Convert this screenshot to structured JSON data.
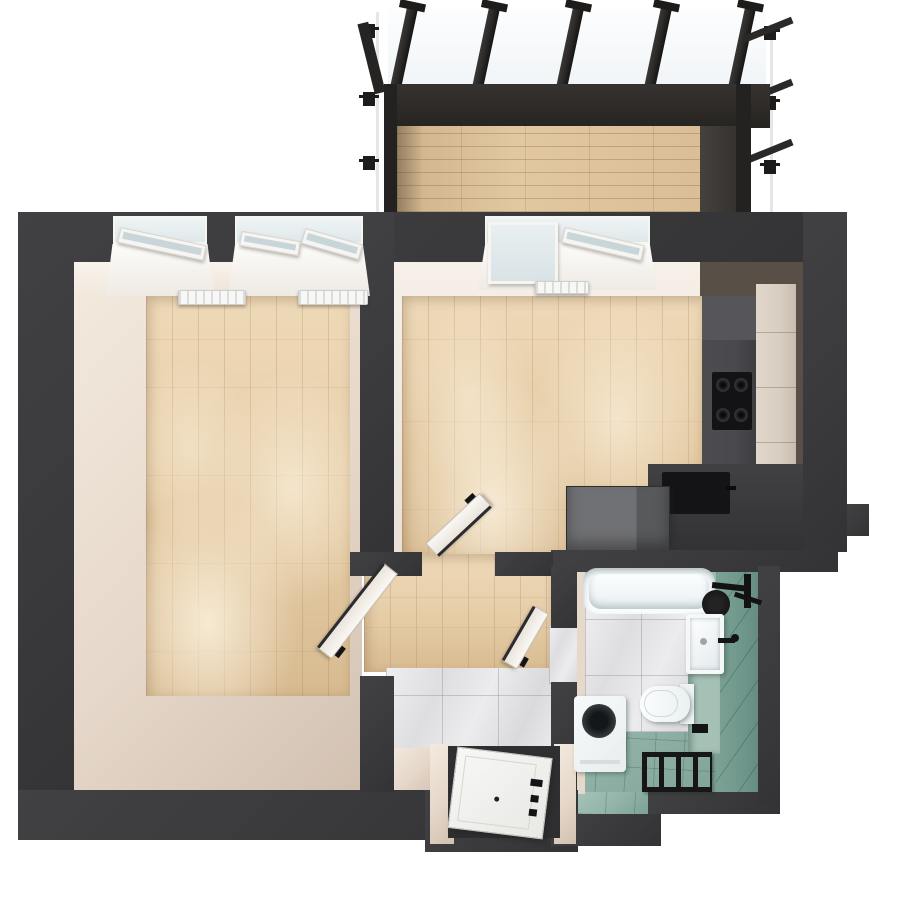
{
  "scene": {
    "type": "3d-floor-plan-top-view",
    "rooms": [
      {
        "name": "balcony",
        "floor": "wood-deck",
        "features": [
          "pergola-rafters",
          "glass-railing",
          "metal-frame"
        ]
      },
      {
        "name": "living-room",
        "floor": "wood-planks",
        "features": [
          "window-1",
          "window-2",
          "radiator-1",
          "radiator-2",
          "open-door-to-hallway"
        ]
      },
      {
        "name": "kitchen",
        "floor": "wood-planks",
        "features": [
          "balcony-door",
          "tilted-window",
          "radiator-3",
          "tall-cabinets",
          "gas-hob",
          "counter-sink",
          "island",
          "open-door-to-hallway"
        ]
      },
      {
        "name": "hallway",
        "floor": "wood-and-marble-tile",
        "features": [
          "entrance-door",
          "door-to-bathroom"
        ]
      },
      {
        "name": "bathroom",
        "floor": "teal-tile-and-marble",
        "features": [
          "bathtub",
          "black-shower",
          "washbasin",
          "wall-hung-toilet",
          "washing-machine",
          "towel-radiator"
        ]
      }
    ]
  },
  "palette": {
    "bg": "#ffffff",
    "wall": "#3a3a3c",
    "beam": "#2b2927",
    "beamDark": "#1d1c1b",
    "woodLight": "#eed9b8",
    "wood": "#e4cba4",
    "woodDark": "#d7ba90",
    "deck": "#d8bc95",
    "beige": "#e6d8ca",
    "beigeDark": "#d2c1b1",
    "beigeLight": "#f3eadf",
    "brownFace": "#584f46",
    "marbleLine": "#c9c9cd",
    "teal": "#95b6ab",
    "tealWall": "#6f968a",
    "tealLedge": "#a5c0b5",
    "white": "#f6f9fa",
    "glass": "#dfe8ea",
    "frame": "#f6f5f2",
    "black": "#141416",
    "cabinet": "#4a4a4e",
    "counterDark": "#3a3a3d",
    "island": "#6b6c6e",
    "cabBeige": "#d8cec1"
  },
  "balcony": {
    "rafters": {
      "xs": [
        390,
        472,
        556,
        644,
        728
      ],
      "top_y": 6,
      "len": 82,
      "tilt_deg": 12,
      "stub_y": 128
    },
    "left_clamps": {
      "x": 363,
      "ys": [
        24,
        92,
        156
      ]
    },
    "right_clamps": {
      "x": 764,
      "ys": [
        26,
        96,
        160
      ]
    },
    "right_braces": {
      "x": 744,
      "ys": [
        36,
        98,
        158
      ],
      "tilt_deg": -22,
      "len": 52
    }
  },
  "radiators": [
    {
      "name": "living-radiator-1",
      "x": 178,
      "y": 290,
      "w": 68,
      "h": 15
    },
    {
      "name": "living-radiator-2",
      "x": 298,
      "y": 290,
      "w": 70,
      "h": 15
    },
    {
      "name": "kitchen-radiator",
      "x": 535,
      "y": 281,
      "w": 54,
      "h": 13
    }
  ],
  "fixtures": {
    "bathtub": "white",
    "shower": "black-round-head",
    "washbasin": "white-black-faucet",
    "toilet": "white-wall-hung",
    "washing_machine": "white-top-view",
    "towel_radiator": "black-ladder",
    "hob": "black-4-burner-gas",
    "kitchen_sink": "black-undermount",
    "island": "grey-block",
    "entrance_door": "white-panel-black-hardware",
    "interior_doors_open": 3,
    "windows": 3
  }
}
